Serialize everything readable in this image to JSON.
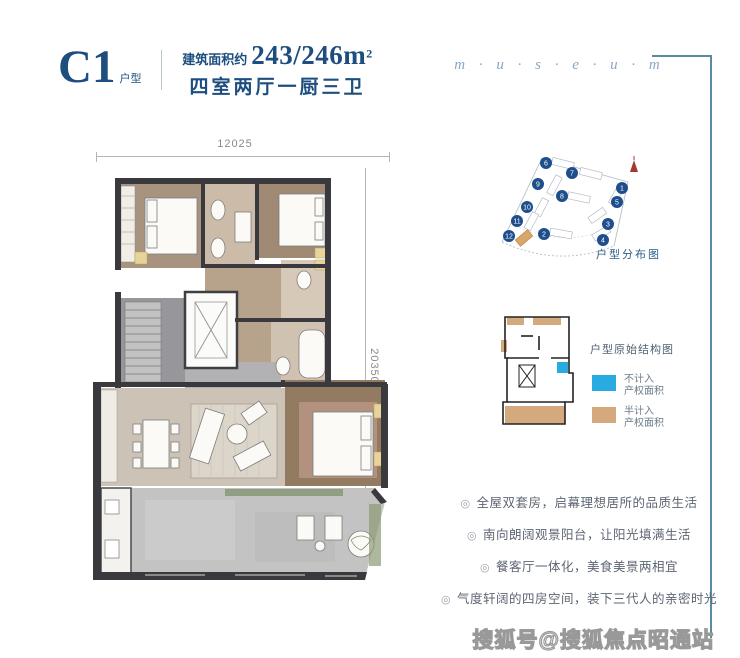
{
  "header": {
    "unit": "C1",
    "unit_type": "户型",
    "area_label": "建筑面积约",
    "area_value": "243/246m",
    "area_sup": "2",
    "layout": "四室两厅一厨三卫",
    "brand": "m · u · s · e · u · m"
  },
  "floorplan": {
    "width_dim": "12025",
    "height_dim": "20350"
  },
  "siteplan": {
    "caption": "户型分布图",
    "building_numbers": [
      "6",
      "7",
      "1",
      "9",
      "8",
      "5",
      "10",
      "11",
      "3",
      "12",
      "2",
      "4"
    ]
  },
  "keyplan": {
    "title": "户型原始结构图",
    "legend": [
      {
        "color": "#29abe2",
        "line1": "不计入",
        "line2": "产权面积"
      },
      {
        "color": "#d3a97d",
        "line1": "半计入",
        "line2": "产权面积"
      }
    ]
  },
  "features": {
    "bullet": "◎",
    "items": [
      "全屋双套房，启幕理想居所的品质生活",
      "南向朗阔观景阳台，让阳光填满生活",
      "餐客厅一体化，美食美景两相宜",
      "气度轩阔的四房空间，装下三代人的亲密时光"
    ]
  },
  "watermark": "搜狐号@搜狐焦点昭通站",
  "colors": {
    "accent_blue": "#1d4e7f",
    "brand_blue": "#8aa6c3",
    "legend_blue": "#29abe2",
    "legend_tan": "#d3a97d",
    "frame_teal": "#5a8ba1"
  }
}
